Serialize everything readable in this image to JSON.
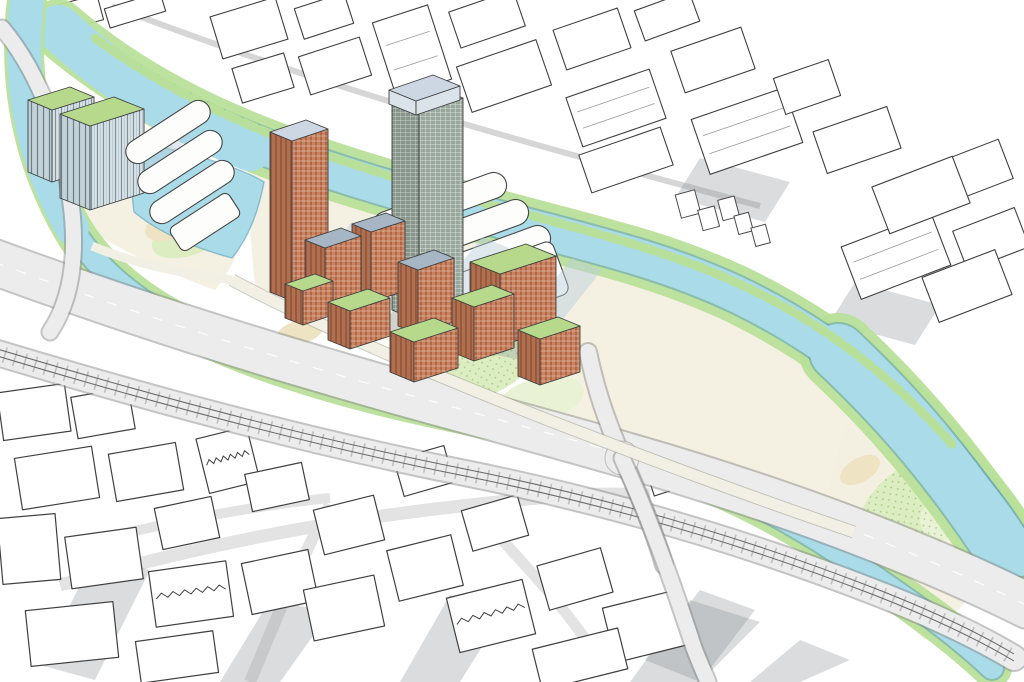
{
  "illustration": {
    "kind": "aerial-masterplan-sketch",
    "labels": {
      "canal": "canal",
      "river": "river",
      "motorway": "motorway-flyover",
      "railway": "railway",
      "site": "riverside-development",
      "context": "sketched-context-buildings"
    }
  },
  "palette": {
    "paper": "#ffffff",
    "line": "#3f3f3f",
    "water": "#a9dbe9",
    "water-edge": "#5f9fb5",
    "bank-green": "#b9e09a",
    "tree-fill": "#a5d37f",
    "tree-light": "#c6e6a4",
    "tree-edge": "#4f8a3a",
    "lawn": "#dcedc2",
    "lawn2": "#e9f2d4",
    "sand": "#eee3c3",
    "cream": "#f3efe0",
    "road": "#ececec",
    "road-edge": "#8a8a8a",
    "glass-crown": "#ccd7e3",
    "green-roof": "#b7d98c",
    "blue-roof": "#a7b6c4",
    "brick": "#c9835f",
    "brick-dark": "#ad6a4b",
    "salmon": "#d08a6f",
    "dark-tower": "#7c4f3b",
    "slab-roof": "#efece0",
    "shadow-grey": "#8c9296",
    "shadow-blue": "#b7cfdc",
    "future-grey": "#dde0e3"
  },
  "scene": {
    "context_north": [
      [
        55,
        0,
        46,
        26,
        -15,
        ""
      ],
      [
        106,
        0,
        58,
        20,
        -17,
        ""
      ],
      [
        215,
        6,
        68,
        44,
        -17,
        ""
      ],
      [
        298,
        0,
        52,
        32,
        -18,
        ""
      ],
      [
        236,
        60,
        54,
        36,
        -17,
        ""
      ],
      [
        303,
        46,
        64,
        40,
        -18,
        ""
      ],
      [
        383,
        12,
        58,
        78,
        -18,
        "i"
      ],
      [
        453,
        0,
        68,
        38,
        -19,
        ""
      ],
      [
        462,
        52,
        84,
        48,
        -19,
        ""
      ],
      [
        558,
        18,
        68,
        42,
        -19,
        ""
      ],
      [
        572,
        82,
        88,
        52,
        -19,
        "i"
      ],
      [
        638,
        0,
        58,
        32,
        -20,
        ""
      ],
      [
        676,
        38,
        74,
        44,
        -19,
        ""
      ],
      [
        698,
        102,
        98,
        58,
        -19,
        "i"
      ],
      [
        778,
        68,
        58,
        38,
        -19,
        ""
      ],
      [
        818,
        118,
        78,
        44,
        -19,
        ""
      ],
      [
        583,
        140,
        86,
        40,
        -19,
        ""
      ],
      [
        848,
        228,
        96,
        56,
        -21,
        "i"
      ],
      [
        940,
        150,
        68,
        42,
        -21,
        ""
      ],
      [
        878,
        170,
        86,
        50,
        -21,
        ""
      ],
      [
        958,
        218,
        66,
        42,
        -21,
        ""
      ],
      [
        928,
        262,
        78,
        48,
        -21,
        ""
      ]
    ],
    "context_south": [
      [
        0,
        388,
        68,
        48,
        -8,
        ""
      ],
      [
        74,
        392,
        58,
        42,
        -10,
        ""
      ],
      [
        18,
        452,
        78,
        52,
        -9,
        ""
      ],
      [
        112,
        448,
        68,
        48,
        -10,
        ""
      ],
      [
        0,
        516,
        58,
        66,
        -5,
        ""
      ],
      [
        68,
        532,
        72,
        52,
        -8,
        ""
      ],
      [
        158,
        502,
        58,
        42,
        -12,
        ""
      ],
      [
        202,
        432,
        52,
        56,
        -14,
        "z"
      ],
      [
        152,
        566,
        78,
        56,
        -8,
        "z"
      ],
      [
        246,
        556,
        68,
        52,
        -12,
        ""
      ],
      [
        248,
        468,
        58,
        38,
        -12,
        ""
      ],
      [
        318,
        502,
        62,
        46,
        -14,
        ""
      ],
      [
        308,
        582,
        72,
        52,
        -12,
        ""
      ],
      [
        392,
        542,
        66,
        52,
        -14,
        ""
      ],
      [
        398,
        452,
        52,
        38,
        -16,
        ""
      ],
      [
        466,
        502,
        58,
        42,
        -16,
        ""
      ],
      [
        452,
        588,
        78,
        56,
        -14,
        "z"
      ],
      [
        542,
        556,
        66,
        46,
        -16,
        ""
      ],
      [
        608,
        598,
        78,
        56,
        -14,
        ""
      ],
      [
        28,
        606,
        88,
        56,
        -6,
        ""
      ],
      [
        138,
        636,
        78,
        42,
        -8,
        ""
      ],
      [
        536,
        638,
        88,
        42,
        -14,
        ""
      ],
      [
        648,
        456,
        44,
        34,
        -18,
        ""
      ]
    ],
    "tree_rows": [
      [
        118,
        55,
        320,
        130,
        8,
        5
      ],
      [
        320,
        130,
        600,
        232,
        10,
        5
      ],
      [
        600,
        232,
        800,
        330,
        7,
        5
      ],
      [
        800,
        330,
        975,
        505,
        7,
        5
      ],
      [
        255,
        178,
        555,
        262,
        10,
        4.5
      ],
      [
        855,
        425,
        1000,
        545,
        5,
        5
      ],
      [
        14,
        60,
        55,
        215,
        5,
        5
      ],
      [
        140,
        152,
        248,
        215,
        4,
        4.5
      ],
      [
        85,
        262,
        300,
        352,
        8,
        4.5
      ],
      [
        300,
        352,
        540,
        428,
        8,
        4.5
      ],
      [
        65,
        300,
        250,
        378,
        6,
        4
      ],
      [
        640,
        475,
        830,
        560,
        6,
        4.5
      ],
      [
        830,
        560,
        975,
        648,
        5,
        4.5
      ],
      [
        245,
        292,
        545,
        420,
        10,
        5
      ],
      [
        560,
        436,
        855,
        520,
        9,
        5
      ],
      [
        586,
        362,
        648,
        542,
        5,
        4.5
      ]
    ],
    "trees": [
      [
        455,
        352,
        7
      ],
      [
        475,
        375,
        6
      ],
      [
        500,
        360,
        5
      ],
      [
        520,
        390,
        6
      ],
      [
        545,
        400,
        5
      ],
      [
        570,
        415,
        6
      ],
      [
        600,
        430,
        5
      ],
      [
        625,
        445,
        6
      ],
      [
        455,
        405,
        5
      ],
      [
        430,
        380,
        6
      ],
      [
        880,
        450,
        6
      ],
      [
        905,
        470,
        6
      ],
      [
        930,
        495,
        7
      ],
      [
        955,
        520,
        6
      ],
      [
        895,
        525,
        6
      ],
      [
        870,
        495,
        5
      ],
      [
        975,
        550,
        5
      ],
      [
        300,
        320,
        5
      ],
      [
        320,
        345,
        5
      ],
      [
        360,
        365,
        5
      ],
      [
        395,
        380,
        5
      ],
      [
        270,
        300,
        5
      ],
      [
        200,
        240,
        5
      ],
      [
        225,
        260,
        5
      ],
      [
        175,
        215,
        5
      ],
      [
        90,
        235,
        5
      ],
      [
        120,
        255,
        5
      ],
      [
        340,
        240,
        4
      ],
      [
        370,
        255,
        4
      ],
      [
        410,
        275,
        4
      ],
      [
        440,
        300,
        4
      ],
      [
        470,
        320,
        4
      ],
      [
        742,
        522,
        4
      ],
      [
        762,
        548,
        4
      ],
      [
        700,
        500,
        4
      ],
      [
        130,
        90,
        4
      ],
      [
        155,
        100,
        4
      ],
      [
        655,
        300,
        4
      ],
      [
        680,
        318,
        4
      ],
      [
        730,
        345,
        4
      ],
      [
        760,
        365,
        4
      ],
      [
        800,
        390,
        4
      ],
      [
        835,
        410,
        4
      ]
    ],
    "stall_rows": [
      [
        282,
        244,
        3.5,
        7,
        6
      ],
      [
        332,
        272,
        4.5,
        6.5,
        7
      ],
      [
        414,
        259,
        4,
        6.5,
        5
      ],
      [
        352,
        373,
        5,
        5,
        2
      ]
    ],
    "stall_colors": [
      "#d84b37",
      "#eda43b",
      "#ecd13e",
      "#e273a9"
    ],
    "boats": [
      [
        352,
        176,
        -18,
        30,
        8
      ],
      [
        972,
        448,
        -50,
        34,
        8
      ],
      [
        18,
        156,
        25,
        24,
        7
      ]
    ],
    "cars": [
      [
        150,
        302,
        -17
      ],
      [
        262,
        348,
        -18
      ],
      [
        436,
        402,
        -16
      ],
      [
        700,
        487,
        -18
      ],
      [
        622,
        470,
        -70
      ],
      [
        530,
        424,
        -17
      ],
      [
        820,
        530,
        -22
      ]
    ],
    "ducks": [
      [
        193,
        206
      ],
      [
        212,
        218
      ],
      [
        228,
        202
      ],
      [
        206,
        232
      ],
      [
        238,
        224
      ],
      [
        362,
        195
      ]
    ],
    "boxes_back": [
      {
        "name": "office-tower-west-a",
        "A": [
          28,
          100
        ],
        "e1": [
          42,
          -13
        ],
        "e2": [
          24,
          10
        ],
        "h": 72,
        "top": "green",
        "f1": "glassD",
        "f2": "glass",
        "shadow": true
      },
      {
        "name": "office-tower-west-b",
        "A": [
          60,
          114
        ],
        "e1": [
          54,
          -17
        ],
        "e2": [
          30,
          12
        ],
        "h": 84,
        "top": "green",
        "f1": "glassD",
        "f2": "glass",
        "shadow": true
      }
    ],
    "boxes": [
      {
        "name": "residential-tower-brick",
        "A": [
          270,
          132
        ],
        "e1": [
          36,
          -12
        ],
        "e2": [
          22,
          9
        ],
        "h": 160,
        "top": "crown",
        "f1": "brickD",
        "f2": "brick",
        "shadow": true
      },
      {
        "name": "landmark-tower",
        "A": [
          392,
          102
        ],
        "e1": [
          44,
          -15
        ],
        "e2": [
          27,
          11
        ],
        "h": 208,
        "top": "crown",
        "f1": "gridD",
        "f2": "grid",
        "shadow": true
      },
      {
        "name": "landmark-tower-crown",
        "A": [
          389,
          90
        ],
        "e1": [
          44,
          -15
        ],
        "e2": [
          27,
          11
        ],
        "h": 14,
        "top": "crown",
        "f1": "crownF",
        "f2": "crownF"
      },
      {
        "name": "midrise-block",
        "A": [
          352,
          224
        ],
        "e1": [
          34,
          -11
        ],
        "e2": [
          19,
          8
        ],
        "h": 70,
        "top": "blue",
        "f1": "brickD",
        "f2": "brick"
      },
      {
        "name": "midrise-block",
        "A": [
          305,
          240
        ],
        "e1": [
          36,
          -12
        ],
        "e2": [
          20,
          8
        ],
        "h": 56,
        "top": "blue",
        "f1": "brickD",
        "f2": "brick"
      },
      {
        "name": "midrise-block",
        "A": [
          398,
          262
        ],
        "e1": [
          36,
          -12
        ],
        "e2": [
          20,
          8
        ],
        "h": 64,
        "top": "blue",
        "f1": "brickD",
        "f2": "brick"
      },
      {
        "name": "midrise-block",
        "A": [
          470,
          262
        ],
        "e1": [
          56,
          -18
        ],
        "e2": [
          30,
          12
        ],
        "h": 72,
        "top": "green",
        "f1": "brickD",
        "f2": "brick",
        "shadow": true
      },
      {
        "name": "midrise-terrace",
        "A": [
          285,
          284
        ],
        "e1": [
          30,
          -10
        ],
        "e2": [
          18,
          7
        ],
        "h": 34,
        "top": "green",
        "f1": "brickD",
        "f2": "brick"
      },
      {
        "name": "midrise-terrace",
        "A": [
          328,
          302
        ],
        "e1": [
          40,
          -13
        ],
        "e2": [
          22,
          9
        ],
        "h": 38,
        "top": "green",
        "f1": "brickD",
        "f2": "brick"
      },
      {
        "name": "midrise-block",
        "A": [
          452,
          298
        ],
        "e1": [
          40,
          -13
        ],
        "e2": [
          22,
          9
        ],
        "h": 54,
        "top": "green",
        "f1": "brickD",
        "f2": "brick"
      },
      {
        "name": "midrise-terrace",
        "A": [
          390,
          332
        ],
        "e1": [
          44,
          -14
        ],
        "e2": [
          24,
          10
        ],
        "h": 40,
        "top": "green",
        "f1": "brickD",
        "f2": "brick"
      },
      {
        "name": "midrise-block",
        "A": [
          518,
          330
        ],
        "e1": [
          40,
          -13
        ],
        "e2": [
          22,
          9
        ],
        "h": 46,
        "top": "green",
        "f1": "brickD",
        "f2": "brick"
      },
      {
        "name": "riverside-slab",
        "kind": "slab",
        "A": [
          545,
          370
        ]
      },
      {
        "name": "riverside-slab",
        "kind": "slab",
        "A": [
          597,
          389
        ]
      },
      {
        "name": "riverside-slab",
        "kind": "slab",
        "A": [
          649,
          408
        ]
      },
      {
        "name": "riverside-slab",
        "kind": "slab",
        "A": [
          701,
          427
        ]
      },
      {
        "name": "riverside-slab",
        "kind": "slab",
        "A": [
          751,
          447
        ]
      },
      {
        "name": "courtyard-block-east",
        "A": [
          766,
          368
        ],
        "e1": [
          52,
          -17
        ],
        "e2": [
          30,
          12
        ],
        "h": 32,
        "top": "grey",
        "f1": "brickD",
        "f2": "brick"
      },
      {
        "name": "brick-tower-east",
        "A": [
          836,
          372
        ],
        "e1": [
          30,
          -10
        ],
        "e2": [
          20,
          8
        ],
        "h": 86,
        "top": "crown",
        "f1": "darkP",
        "f2": "darkP",
        "shadow": true
      },
      {
        "name": "station-shed",
        "A": [
          568,
          404
        ],
        "e1": [
          52,
          -17
        ],
        "e2": [
          20,
          8
        ],
        "h": 15,
        "top": "grey",
        "f1": "greyF",
        "f2": "greyF"
      },
      {
        "name": "future-tower",
        "A": [
          850,
          410
        ],
        "e1": [
          34,
          -11
        ],
        "e2": [
          23,
          9
        ],
        "h": 90,
        "top": "white",
        "f1": "greyF",
        "f2": "whiteF",
        "shadow": true
      },
      {
        "name": "future-tower",
        "A": [
          912,
          444
        ],
        "e1": [
          34,
          -11
        ],
        "e2": [
          23,
          9
        ],
        "h": 96,
        "top": "white",
        "f1": "greyF",
        "f2": "whiteF",
        "shadow": true
      },
      {
        "name": "future-tower",
        "A": [
          976,
          498
        ],
        "e1": [
          34,
          -11
        ],
        "e2": [
          23,
          9
        ],
        "h": 88,
        "top": "white",
        "f1": "greyF",
        "f2": "whiteF",
        "shadow": true
      },
      {
        "name": "context-tower",
        "A": [
          698,
          556
        ],
        "e1": [
          50,
          -16
        ],
        "e2": [
          33,
          13
        ],
        "h": 108,
        "top": "white",
        "f1": "greyF",
        "f2": "whiteF"
      },
      {
        "name": "context-tower",
        "A": [
          798,
          602
        ],
        "e1": [
          50,
          -16
        ],
        "e2": [
          33,
          13
        ],
        "h": 86,
        "top": "white",
        "f1": "greyF",
        "f2": "whiteF"
      },
      {
        "name": "context-tower",
        "A": [
          892,
          648
        ],
        "e1": [
          46,
          -15
        ],
        "e2": [
          30,
          12
        ],
        "h": 52,
        "top": "white",
        "f1": "greyF",
        "f2": "whiteF"
      }
    ]
  }
}
